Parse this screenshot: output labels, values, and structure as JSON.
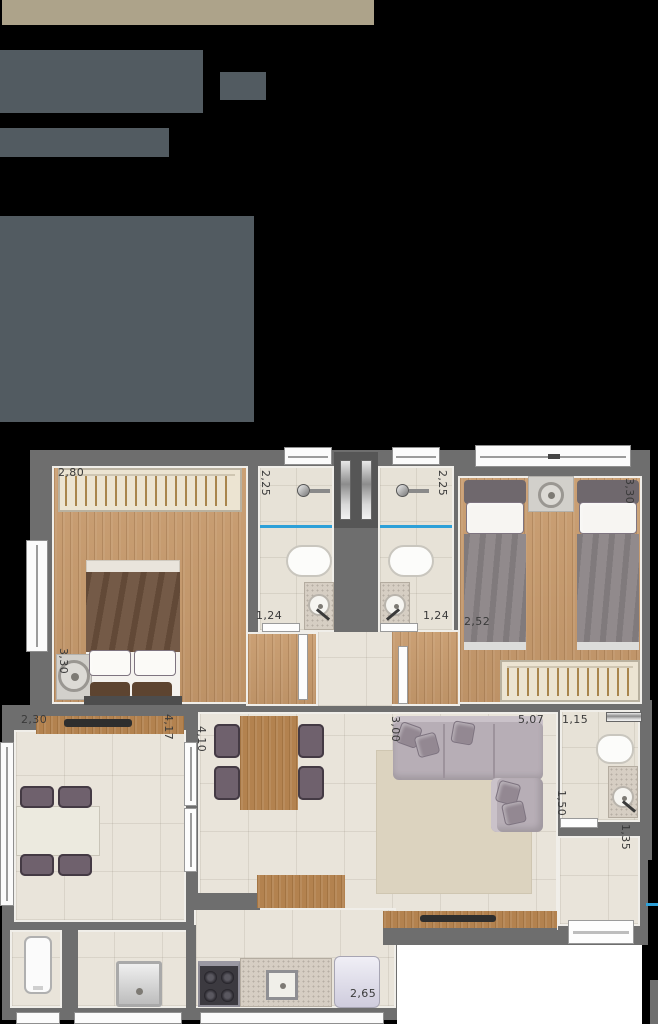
{
  "header": {
    "banner_color": "#ada38a",
    "block_color": "#525b61"
  },
  "plan": {
    "labels": {
      "bedroom1_width": "2,80",
      "bedroom1_depth": "3,30",
      "bath1_depth": "2,25",
      "bath1_width": "1,24",
      "bath2_depth": "2,25",
      "bath2_width": "1,24",
      "bedroom2_depth": "3,30",
      "bedroom2_entry_width": "2,52",
      "balcony_width": "2,30",
      "balcony_length": "4,17",
      "living_length": "4,10",
      "living_sofa_wall": "3,00",
      "living_width": "5,07",
      "lavabo_width": "1,15",
      "lavabo_depth": "1,50",
      "entry_hall_width": "1,35",
      "kitchen_width": "2,65"
    },
    "colors": {
      "wall": "#6e6e6e",
      "wood_floor": "#c79a6c",
      "tile_floor": "#e9e4da",
      "shower_glass": "#2da0d8",
      "sofa": "#b7aeb6",
      "bed1_blanket": "#6d513d",
      "bed2_blanket": "#8b8486"
    }
  }
}
